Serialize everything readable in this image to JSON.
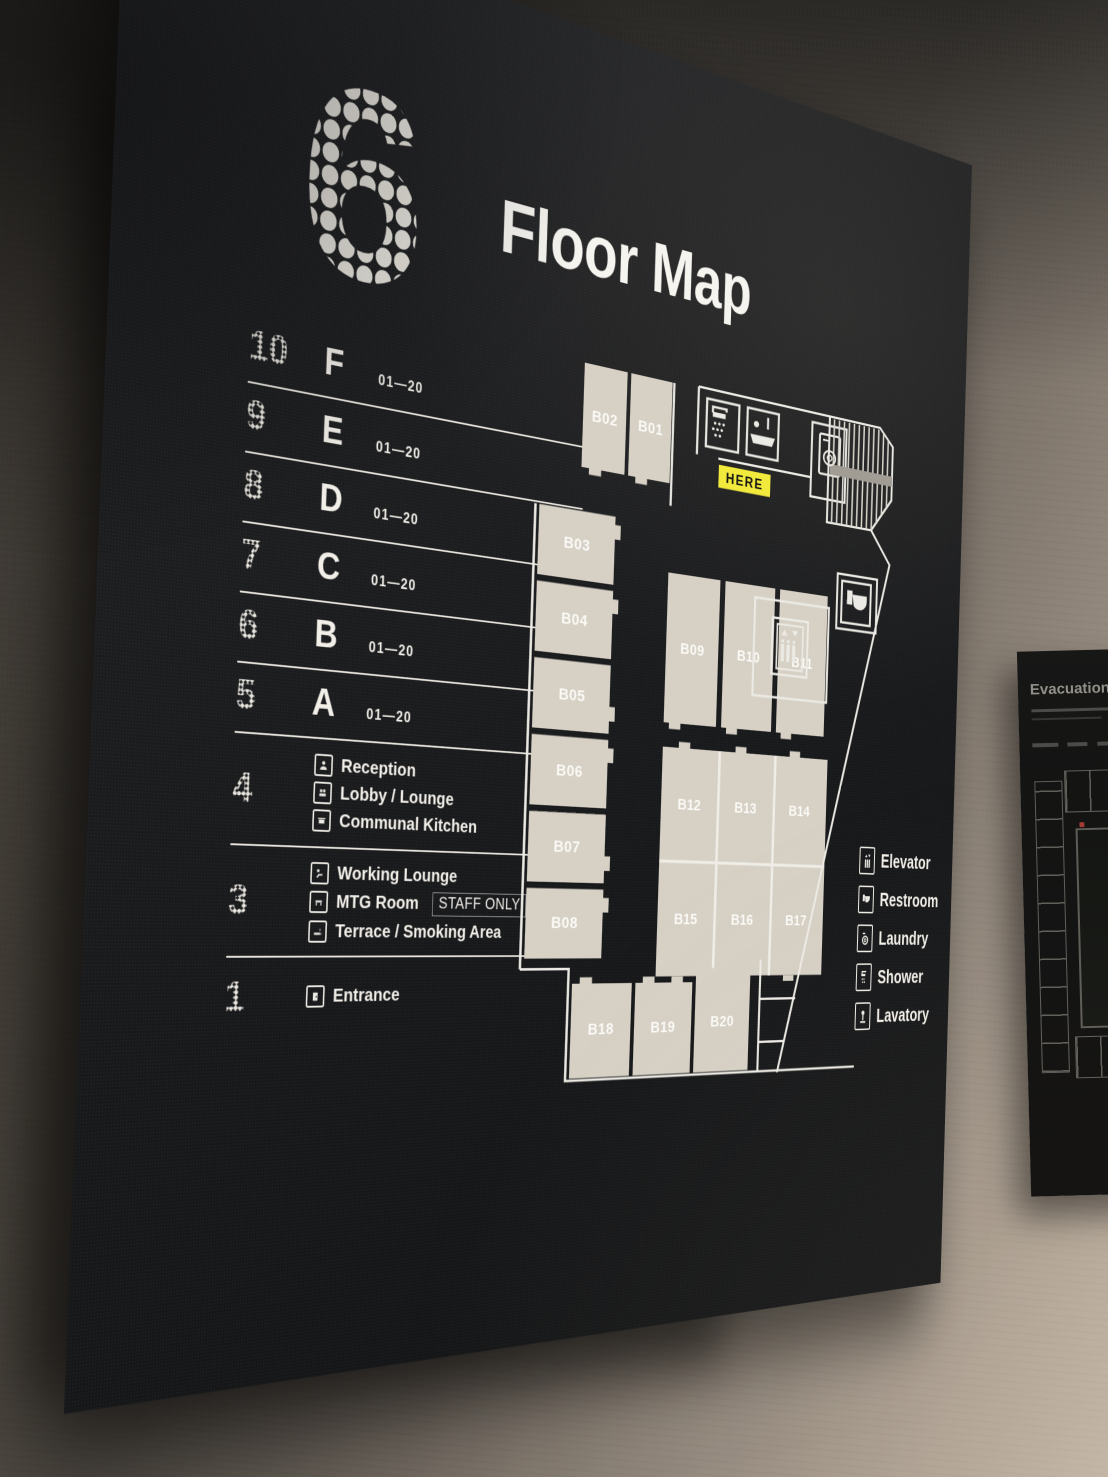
{
  "colors": {
    "board": "#1a1b1d",
    "wall": "#6e665e",
    "room_beige": "#d6d0c5",
    "line_white": "#eceae4",
    "here_yellow": "#f2e93d",
    "text": "#f2efe9"
  },
  "board": {
    "floor_badge": "6",
    "title": "Floor Map",
    "floor_rows": [
      {
        "num": "10",
        "letter": "F",
        "range": "01—20"
      },
      {
        "num": "9",
        "letter": "E",
        "range": "01—20"
      },
      {
        "num": "8",
        "letter": "D",
        "range": "01—20"
      },
      {
        "num": "7",
        "letter": "C",
        "range": "01—20"
      },
      {
        "num": "6",
        "letter": "B",
        "range": "01—20"
      },
      {
        "num": "5",
        "letter": "A",
        "range": "01—20"
      }
    ],
    "amenity_rows": [
      {
        "num": "4",
        "items": [
          {
            "icon": "reception-icon",
            "label": "Reception"
          },
          {
            "icon": "lobby-lounge-icon",
            "label": "Lobby / Lounge"
          },
          {
            "icon": "communal-kitchen-icon",
            "label": "Communal Kitchen"
          }
        ]
      },
      {
        "num": "3",
        "items": [
          {
            "icon": "working-lounge-icon",
            "label": "Working Lounge"
          },
          {
            "icon": "mtg-room-icon",
            "label": "MTG Room",
            "tag": "STAFF ONLY"
          },
          {
            "icon": "terrace-icon",
            "label": "Terrace / Smoking Area"
          }
        ]
      },
      {
        "num": "1",
        "items": [
          {
            "icon": "entrance-icon",
            "label": "Entrance"
          }
        ]
      }
    ],
    "map": {
      "here": "HERE",
      "rooms": {
        "top": [
          "B02",
          "B01"
        ],
        "left": [
          "B03",
          "B04",
          "B05",
          "B06",
          "B07",
          "B08"
        ],
        "island_top": [
          "B09",
          "B10",
          "B11"
        ],
        "island_mid": [
          "B12",
          "B13",
          "B14"
        ],
        "island_bottom": [
          "B15",
          "B16",
          "B17"
        ],
        "south": [
          "B18",
          "B19",
          "B20"
        ]
      },
      "legend": [
        {
          "icon": "elevator-icon",
          "label": "Elevator"
        },
        {
          "icon": "restroom-icon",
          "label": "Restroom"
        },
        {
          "icon": "laundry-icon",
          "label": "Laundry"
        },
        {
          "icon": "shower-icon",
          "label": "Shower"
        },
        {
          "icon": "lavatory-icon",
          "label": "Lavatory"
        }
      ]
    }
  },
  "adjacent_sign": {
    "title": "Evacuation Route"
  }
}
